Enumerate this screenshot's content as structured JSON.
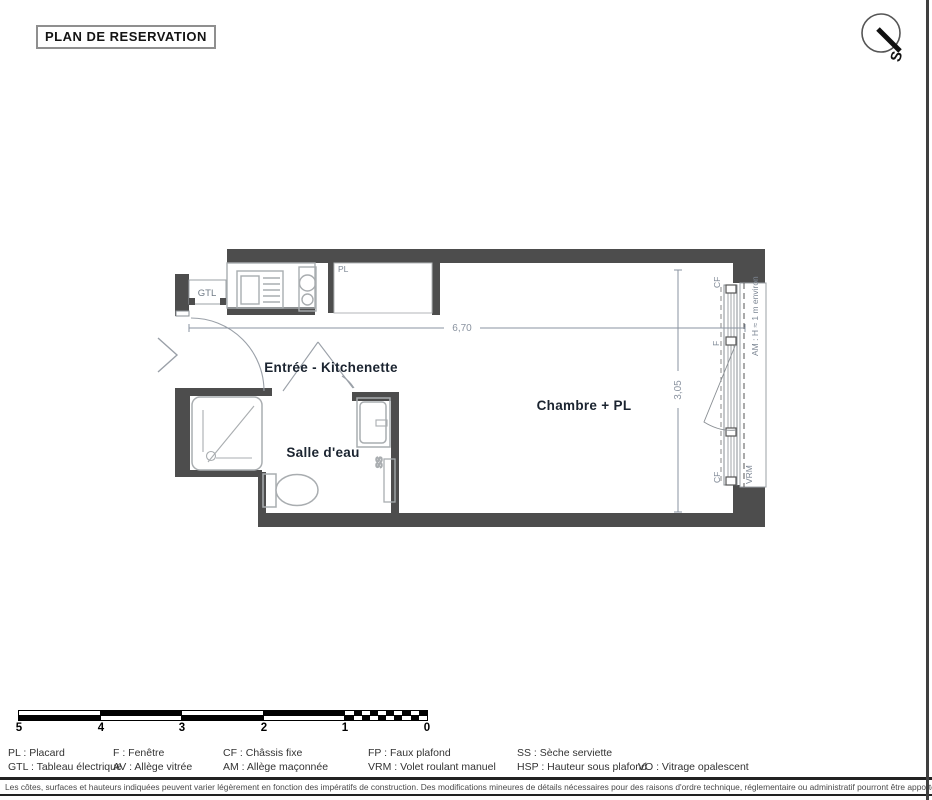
{
  "title": "PLAN DE RESERVATION",
  "compass": {
    "south_letter": "S"
  },
  "plan": {
    "room_labels": {
      "entree": "Entrée - Kitchenette",
      "salle_deau": "Salle d'eau",
      "chambre": "Chambre + PL"
    },
    "annotations": {
      "gtl": "GTL",
      "pl": "PL",
      "cf_top": "CF",
      "f_window": "F",
      "cf_bottom": "CF",
      "vrm": "VRM",
      "am_height": "AM : H ≈ 1 m environ",
      "ss": "SS"
    },
    "dimensions": {
      "width_m": "6,70",
      "depth_m": "3,05"
    }
  },
  "scale_bar": {
    "tick_labels": [
      "5",
      "4",
      "3",
      "2",
      "1",
      "0"
    ]
  },
  "legend": {
    "items": [
      "PL : Placard",
      "F : Fenêtre",
      "CF : Châssis fixe",
      "FP : Faux plafond",
      "SS : Sèche serviette",
      "GTL : Tableau électrique",
      "AV : Allège vitrée",
      "AM : Allège maçonnée",
      "VRM : Volet roulant manuel",
      "HSP : Hauteur sous plafond",
      "VO : Vitrage opalescent"
    ]
  },
  "footnote": "Les côtes, surfaces et hauteurs indiquées peuvent varier légèrement en fonction des impératifs de construction. Des modifications mineures de détails nécessaires pour des raisons d'ordre technique, réglementaire ou administratif pourront être apportées sur les plans. Seuls les plans déposés au rang des minutes du notaire font foi.",
  "colors": {
    "wall": "#4d4d4d",
    "fixture_outline": "#a9adb0",
    "label_gray": "#7d8794",
    "room_label": "#1b2430",
    "accent_black": "#1a1a1a"
  }
}
